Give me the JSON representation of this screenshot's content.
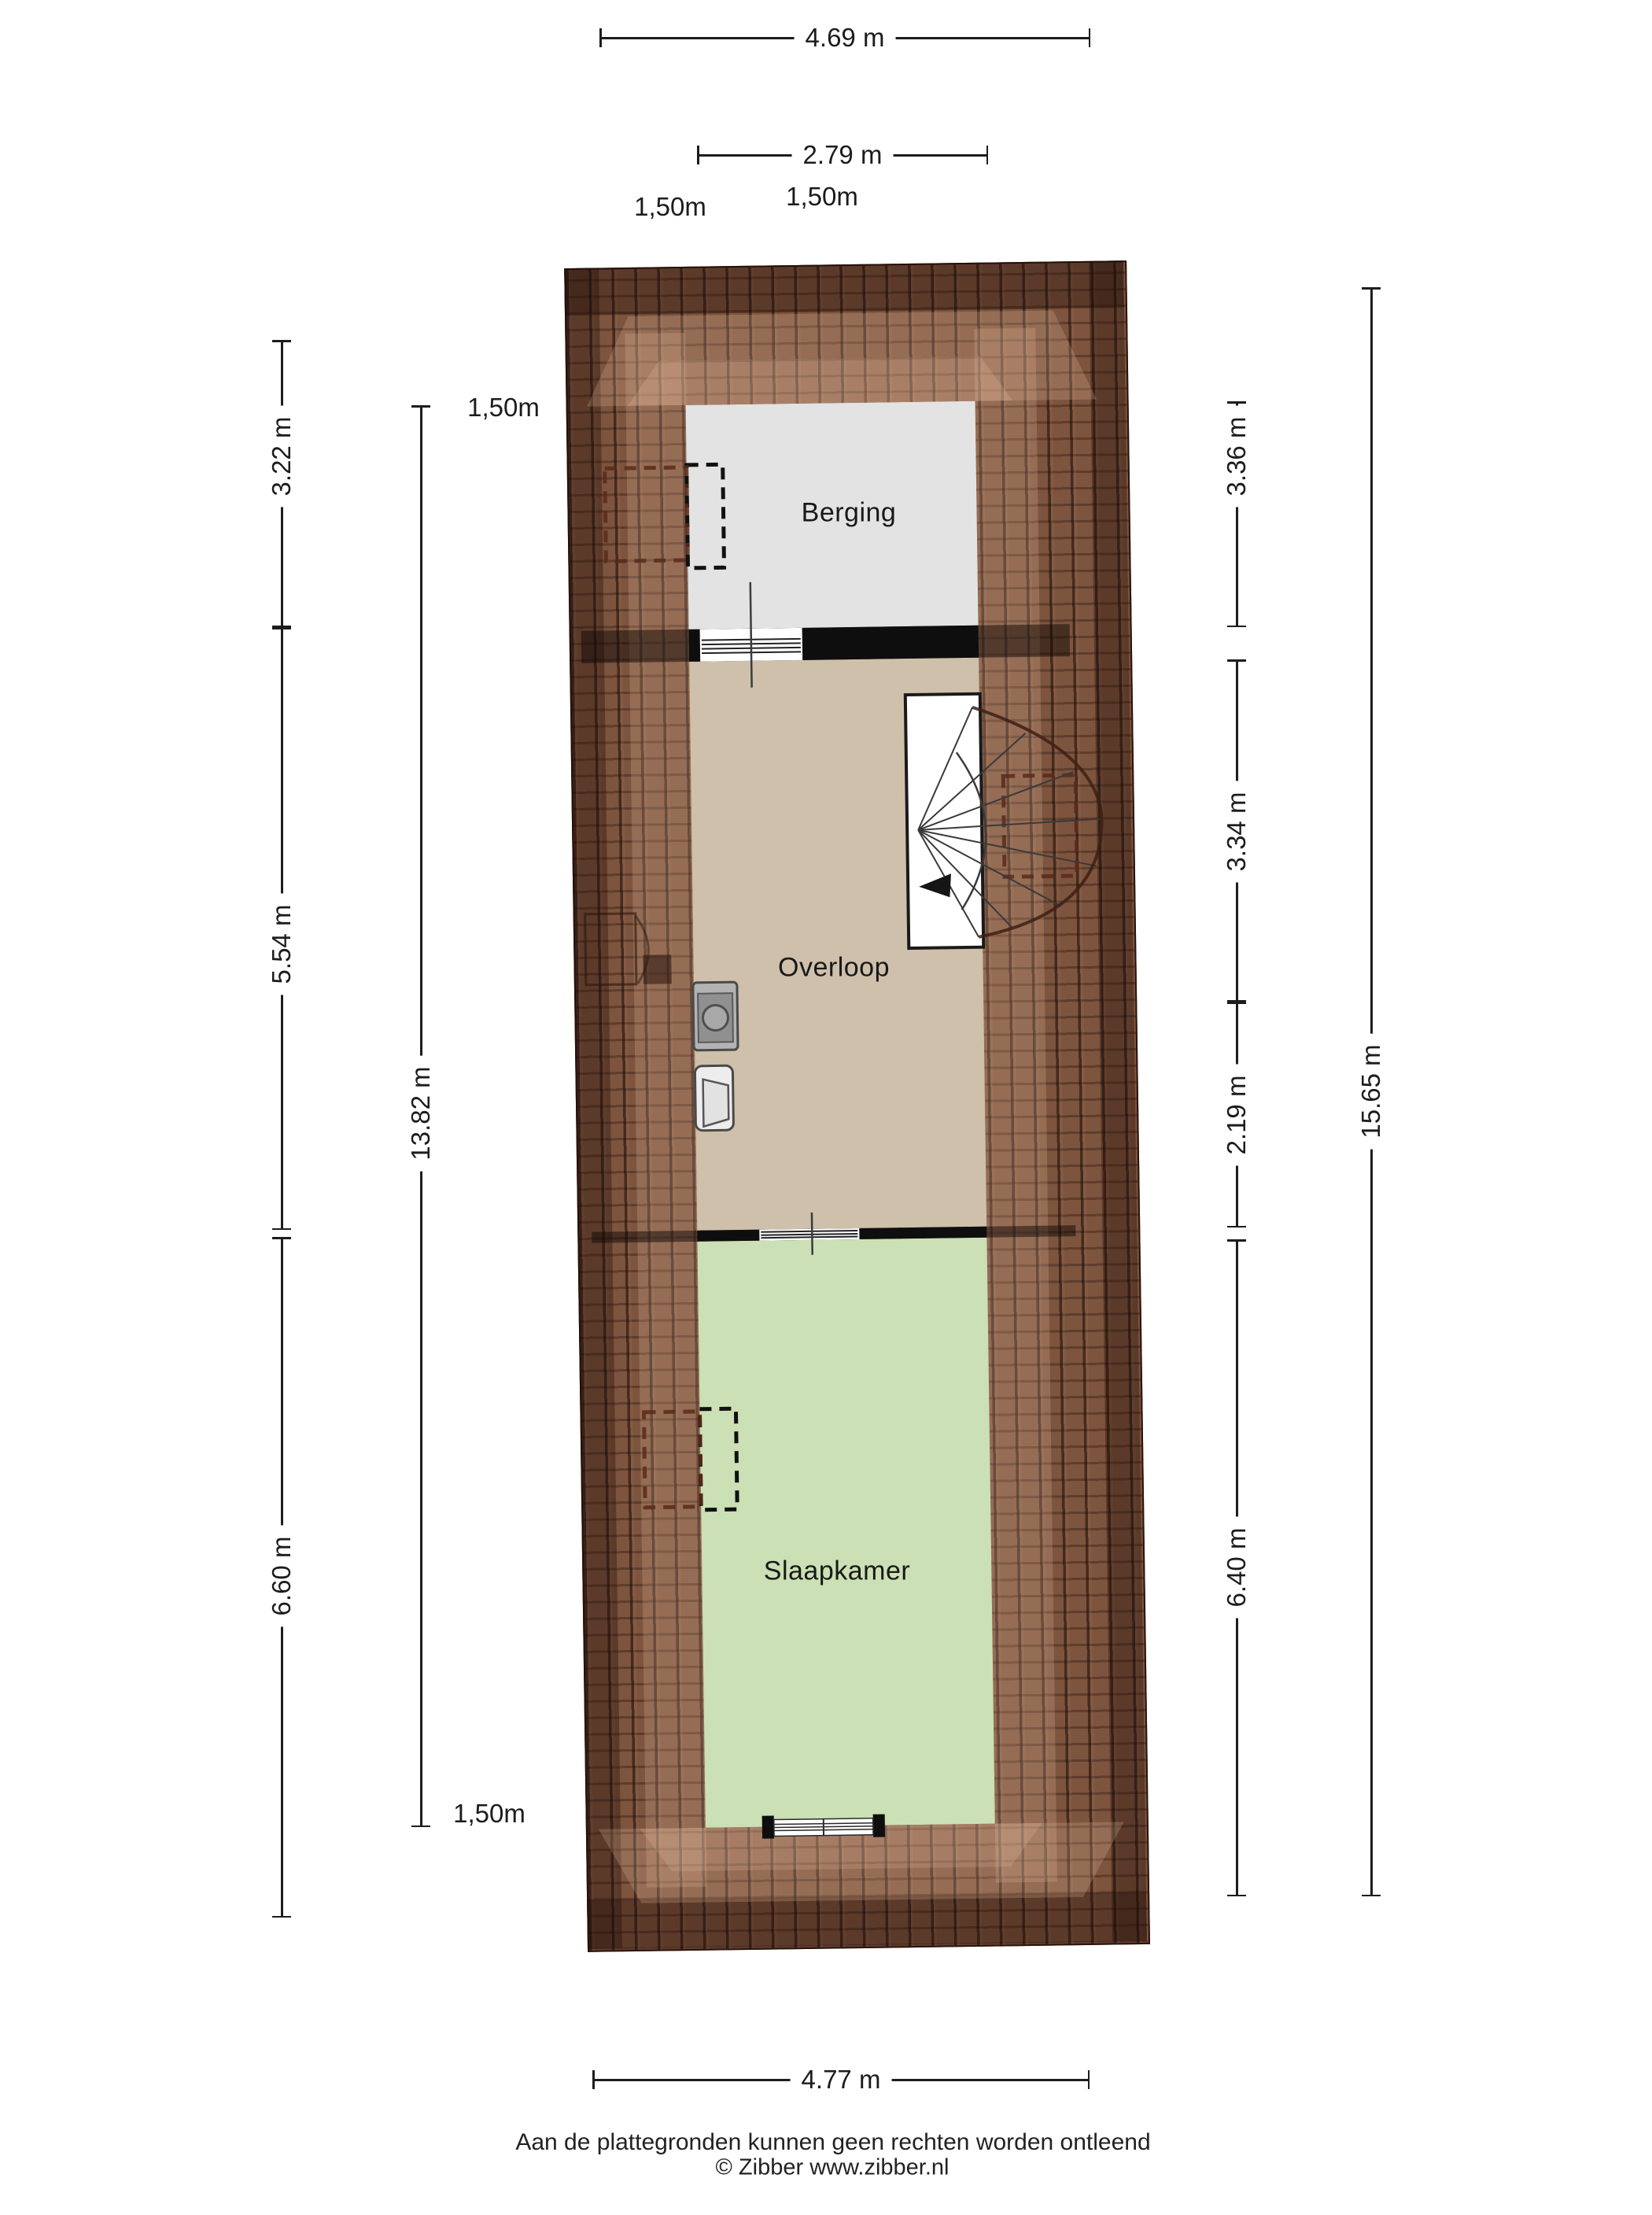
{
  "title": "Attic floor plan (plattegrond)",
  "plan": {
    "rooms": {
      "berging": {
        "label": "Berging"
      },
      "overloop": {
        "label": "Overloop"
      },
      "slaapkamer": {
        "label": "Slaapkamer"
      }
    }
  },
  "dimensions": {
    "top_width": {
      "label": "4.69 m"
    },
    "top_inner_width": {
      "label": "2.79 m"
    },
    "top_left_150": {
      "label": "1,50m"
    },
    "top_right_150": {
      "label": "1,50m"
    },
    "left_berging": {
      "label": "3.22 m"
    },
    "left_overloop": {
      "label": "5.54 m"
    },
    "left_slaapkamer": {
      "label": "6.60 m"
    },
    "left_inner_total": {
      "label": "13.82 m"
    },
    "left_150_top": {
      "label": "1,50m"
    },
    "left_150_bottom": {
      "label": "1,50m"
    },
    "right_berging": {
      "label": "3.36 m"
    },
    "right_overloop_a": {
      "label": "3.34 m"
    },
    "right_overloop_b": {
      "label": "2.19 m"
    },
    "right_slaapkamer": {
      "label": "6.40 m"
    },
    "right_total": {
      "label": "15.65 m"
    },
    "bottom_width": {
      "label": "4.77 m"
    }
  },
  "footer": {
    "disclaimer": "Aan de plattegronden kunnen geen rechten worden ontleend",
    "credit": "© Zibber www.zibber.nl"
  },
  "colors": {
    "berging_floor": "#e3e3e3",
    "overloop_floor": "#cec0ab",
    "slaapkamer_floor": "#cbe0b4",
    "roof_base": "#7d543e",
    "wall": "#0e0e0e",
    "roof_marking_dashed": "#5a2d20",
    "window_dashed": "#111111"
  }
}
